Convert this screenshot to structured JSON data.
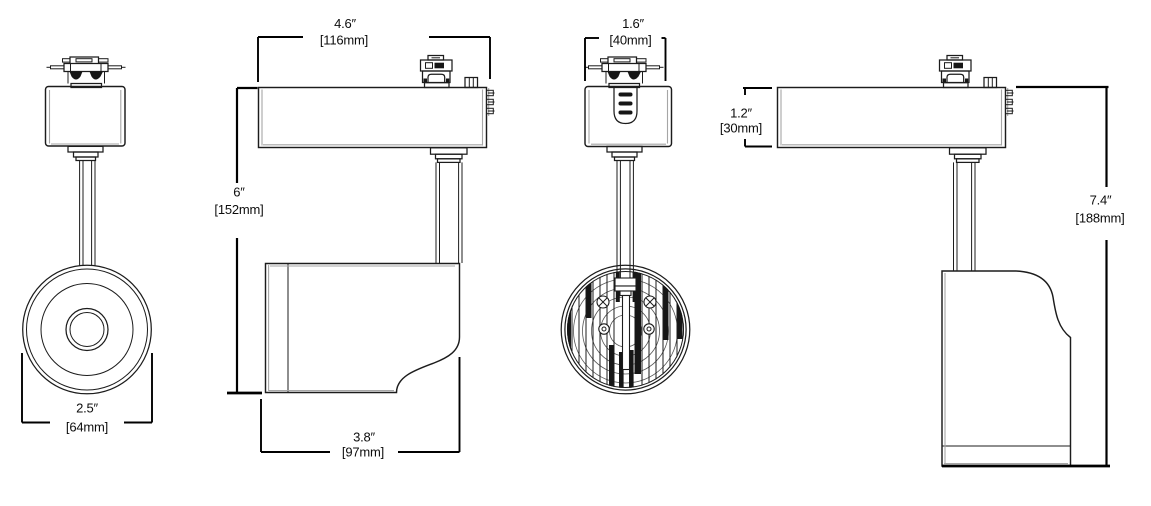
{
  "diagram": {
    "type": "technical-dimension-drawing",
    "subject": "led-track-light-fixture-four-views",
    "background": "#ffffff",
    "line_color": "#1c1c1c",
    "shade_color": "#a6a6a6",
    "dimensions": {
      "lens_diameter": {
        "in": "2.5″",
        "mm": "[64mm]"
      },
      "housing_width": {
        "in": "4.6″",
        "mm": "[116mm]"
      },
      "mount_height": {
        "in": "6″",
        "mm": "[152mm]"
      },
      "head_length": {
        "in": "3.8″",
        "mm": "[97mm]"
      },
      "adapter_width": {
        "in": "1.6″",
        "mm": "[40mm]"
      },
      "housing_height": {
        "in": "1.2″",
        "mm": "[30mm]"
      },
      "overall_height": {
        "in": "7.4″",
        "mm": "[188mm]"
      }
    }
  }
}
